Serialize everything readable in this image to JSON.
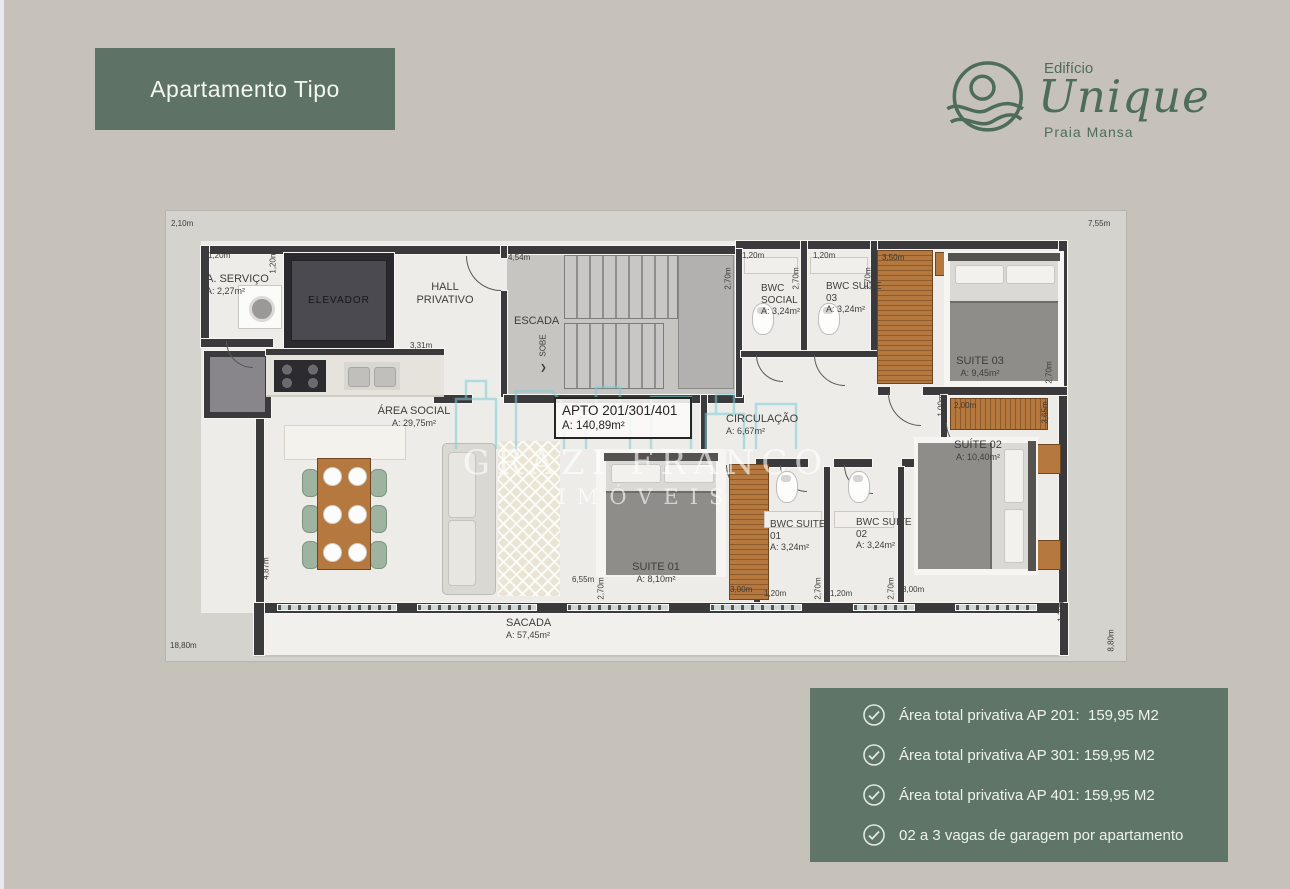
{
  "header": {
    "title": "Apartamento Tipo"
  },
  "logo": {
    "building": "Edifício",
    "name": "Unique",
    "subtitle": "Praia Mansa"
  },
  "colors": {
    "green": "#5e7365",
    "logo_green": "#4d6c59",
    "wall": "#3a393c",
    "wood": "#b5783f",
    "background": "#c6c2ba"
  },
  "floorplan": {
    "apto_label": {
      "title": "APTO 201/301/401",
      "area": "A: 140,89m²"
    },
    "rooms": {
      "servico": {
        "name": "A. SERVIÇO",
        "area": "A: 2,27m²"
      },
      "elevador": {
        "name": "ELEVADOR"
      },
      "hall": {
        "name": "HALL PRIVATIVO"
      },
      "escada": {
        "name": "ESCADA"
      },
      "sobe": {
        "name": "SOBE"
      },
      "area_social": {
        "name": "ÁREA SOCIAL",
        "area": "A: 29,75m²"
      },
      "circulacao": {
        "name": "CIRCULAÇÃO",
        "area": "A: 6,67m²"
      },
      "bwc_social": {
        "name": "BWC SOCIAL",
        "area": "A: 3,24m²"
      },
      "bwc_suite03": {
        "name": "BWC SUITE 03",
        "area": "A: 3,24m²"
      },
      "suite03": {
        "name": "SUITE 03",
        "area": "A: 9,45m²"
      },
      "suite02": {
        "name": "SUÍTE 02",
        "area": "A: 10,40m²"
      },
      "suite01": {
        "name": "SUITE 01",
        "area": "A: 8,10m²"
      },
      "bwc_suite01": {
        "name": "BWC SUITE 01",
        "area": "A: 3,24m²"
      },
      "bwc_suite02": {
        "name": "BWC SUITE 02",
        "area": "A: 3,24m²"
      },
      "sacada": {
        "name": "SACADA",
        "area": "A: 57,45m²"
      }
    },
    "dims": {
      "d1": "2,10m",
      "d2": "7,55m",
      "d3": "1,20m",
      "d4": "4,54m",
      "d5v": "2,70m",
      "d6": "1,20m",
      "d7v": "2,70m",
      "d8": "1,20m",
      "d9v": "2,70m",
      "d10": "3,50m",
      "d11v": "2,70m",
      "d12v": "1,00m",
      "d13": "2,00m",
      "d14v": "3,65m",
      "d15": "3,31m",
      "d16v": "4,87m",
      "d17": "6,55m",
      "d18v": "2,70m",
      "d19": "3,00m",
      "d20": "1,20m",
      "d21v": "2,70m",
      "d22": "1,20m",
      "d23v": "2,70m",
      "d24": "3,00m",
      "d25v": "1,20m",
      "d26": "18,80m",
      "d27v": "8,80m",
      "d28v": "1,20m"
    },
    "watermark": {
      "line1": "GRAZI FRANCO",
      "line2": "IMÓVEIS"
    }
  },
  "info_box": {
    "items": [
      "Área total privativa AP 201:  159,95 M2",
      "Área total privativa AP 301: 159,95 M2",
      "Área total privativa AP 401: 159,95 M2",
      "02 a 3 vagas de garagem por apartamento"
    ]
  }
}
